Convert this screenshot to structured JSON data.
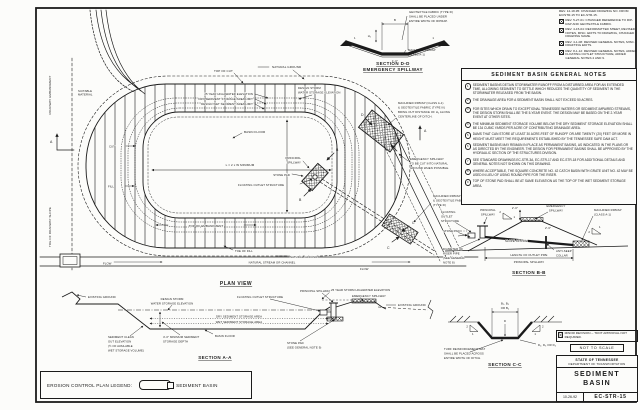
{
  "title_block": {
    "minor_revision_note": "MINOR REVISION -- TDOT APPROVAL NOT REQUIRED.",
    "not_to_scale": "NOT TO SCALE",
    "agency_line1": "STATE OF TENNESSEE",
    "agency_line2": "DEPARTMENT OF TRANSPORTATION",
    "drawing_title_line1": "SEDIMENT",
    "drawing_title_line2": "BASIN",
    "date": "10-26-92",
    "drawing_number": "EC-STR-15"
  },
  "legend": {
    "label": "EROSION CONTROL PLAN LEGEND:",
    "item": "SEDIMENT BASIN"
  },
  "revisions": {
    "items": [
      {
        "text": "REV. 12-18-95: CHANGED DRAWING NO. FROM EC/STR-15 TO EC-STR-15."
      },
      {
        "text": "REV. 5-27-01: CHANGED REFERENCE TO RIP-RAP AND GEOTEXTILE FABRIC."
      },
      {
        "text": "REV. 4-15-04: REFORMATTED SHEET, REVISED NOTES, MISC. EDITS TO DRAWING, CHANGED DRAWING NAME."
      },
      {
        "text": "REV. 4-1-08: REVISED GENERAL NOTES, MISC. DRAFTING EDITS."
      },
      {
        "text": "REV. 8-1-12: REVISED GENERAL NOTES, ADDED FLOATING OUTLET STRUCTURE, ADDED GENERAL NOTES 4 AND 9."
      }
    ]
  },
  "notes": {
    "title": "SEDIMENT BASIN GENERAL NOTES",
    "items": [
      {
        "num": "1",
        "text": "SEDIMENT BASINS DETAIN STORMWATER RUNOFF FROM A DISTURBED AREA FOR AN EXTENDED TIME, ALLOWING SEDIMENT TO SETTLE WHICH REDUCES THE QUANTITY OF SEDIMENT IN THE STORMWATER RELEASED FROM THE BASIN."
      },
      {
        "num": "2",
        "text": "THE DRAINAGE AREA FOR A SEDIMENT BASIN SHALL NOT EXCEED 50 ACRES."
      },
      {
        "num": "3",
        "text": "FOR SITES WHICH DRAIN TO EXCEPTIONAL TENNESSEE WATERS OR SEDIMENT-IMPAIRED STREAMS, THE DESIGN STORM SHALL BE THE 5-YEAR EVENT.  THE DESIGN MAY BE BASED ON THE 2-YEAR EVENT AT OTHER SITES."
      },
      {
        "num": "4",
        "text": "THE MINIMUM SEDIMENT STORAGE VOLUME BELOW THE DRY SEDIMENT STORAGE ELEVATION SHALL BE 134 CUBIC YARDS PER ACRE OF CONTRIBUTING DRAINAGE AREA."
      },
      {
        "num": "5",
        "text": "DAMS THAT CAN STORE AT LEAST 30 ACRE-FEET OF RUNOFF OR ARE TWENTY (20) FEET OR MORE IN HEIGHT MUST MEET THE REQUIREMENTS ESTABLISHED BY THE TENNESSEE SAFE DAM ACT."
      },
      {
        "num": "6",
        "text": "SEDIMENT BASINS MAY REMAIN IN PLACE AS PERMANENT BASINS, AS INDICATED IN THE PLANS OR AS DIRECTED BY THE ENGINEER.  THE DESIGN FOR PERMANENT BASINS SHALL BE APPROVED BY THE HYDRAULIC SECTION OF THE STRUCTURES DIVISION."
      },
      {
        "num": "7",
        "text": "SEE STANDARD DRAWINGS EC-STR-3A, EC-STR-17 AND EC-STR-18 FOR ADDITIONAL DETAILS AND GENERAL NOTES NOT SHOWN ON THIS DRAWING."
      },
      {
        "num": "8",
        "text": "WHERE ACCEPTABLE, THE SQUARE CONCRETE NO. 42 CATCH BASIN WITH GRATE UNIT NO. 42 MAY BE USED IN LIEU OF USING ROUND PIPE FOR THE RISER."
      },
      {
        "num": "9",
        "text": "TOP OF STONE PAD SHALL BE AT SAME ELEVATION AS THE TOP OF THE WET SEDIMENT STORAGE AREA."
      }
    ]
  },
  "plan": {
    "title": "PLAN VIEW",
    "labels": {
      "roadway_embankment": "ROADWAY EMBANKMENT",
      "toe_of_roadway_slope": "TOE OF ROADWAY SLOPE",
      "suitable_material": [
        "SUITABLE",
        "MATERIAL"
      ],
      "top_of_cut": "TOP OF CUT",
      "natural_ground_top": "NATURAL GROUND",
      "hw25": "25 YEAR HIGH WATER ELEVATION",
      "dry_limit": "DRY SEDIMENT STORAGE AREA LIMIT",
      "wet_limit": "DESIGN WET SEDIMENT AREA LIMIT",
      "design_storm": [
        "DESIGN STORM",
        "WATER STORAGE ELEVATION"
      ],
      "basin_floor": "BASIN FLOOR",
      "length_dim": "L = 2 x W MINIMUM",
      "cut": "CUT",
      "fill": "FILL",
      "top_of_embankment": "TOP OF EMBANKMENT",
      "toe_of_fill": "TOE OF FILL",
      "natural_ground_bottom": "NATURAL GROUND",
      "flow": "FLOW",
      "stream": "NATURAL STREAM OR CHANNEL",
      "riprap_ditch_note": [
        "MACHINED RIPRAP (CLASS A-1)",
        "& GEOTEXTILE FABRIC (TYPE III)",
        "BRING OUT DISTANCE OF H₂ ALONG",
        "CENTERLINE OF DITCH."
      ],
      "emergency_note": [
        "EMERGENCY SPILLWAY",
        "TO BE CUT INTO NATURAL",
        "GROUND WHEN POSSIBLE."
      ],
      "riprap_fabric": [
        "MACHINED RIPRAP",
        "& GEOTEXTILE FABRIC",
        "(TYPE III)"
      ],
      "principal_spillway": [
        "PRINCIPAL",
        "SPILLWAY"
      ],
      "stone_pad": "STONE PAD",
      "floating_outlet": "FLOATING OUTLET STRUCTURE",
      "marker_a": "A",
      "marker_b": "B",
      "marker_c": "C",
      "marker_d": "D"
    }
  },
  "section_aa": {
    "title": "SECTION A-A",
    "labels": {
      "existing_ground": "EXISTING GROUND",
      "design_storm": [
        "DESIGN STORM",
        "WATER STORAGE ELEVATION"
      ],
      "floating_outlet": "FLOATING OUTLET STRUCTURE",
      "principal_spillway": "PRINCIPAL SPILLWAY",
      "dry_area": "DRY SEDIMENT STORAGE AREA",
      "wet_area": "WET SEDIMENT STORAGE AREA",
      "cleanout": [
        "SEDIMENT CLEAN",
        "OUT ELEVATION",
        "(½ OF AVAILABLE",
        "WET STORAGE VOLUME)"
      ],
      "min_depth": [
        "4'-0\" MINIMUM SEDIMENT",
        "STORAGE DEPTH"
      ],
      "basin_floor": "BASIN FLOOR",
      "stone_pad": [
        "STONE PAD",
        "(SEE GENERAL NOTE 9)"
      ],
      "hw25": "25 YEAR STORM HIGHWATER ELEVATION",
      "emergency_spillway": "EMERGENCY SPILLWAY",
      "existing_ground_right": "EXISTING GROUND"
    }
  },
  "section_bb": {
    "title": "SECTION B-B",
    "labels": {
      "floating_outlet": [
        "FLOATING",
        "OUTLET",
        "STRUCTURE"
      ],
      "principal": [
        "PRINCIPAL",
        "SPILLWAY"
      ],
      "emergency": [
        "EMERGENCY",
        "SPILLWAY"
      ],
      "riprap": [
        "MACHINED RIPRAP",
        "(CLASS A-1)"
      ],
      "dim1": "2'-0\"",
      "dim2": "2' MIN.",
      "dim3": "2'-6\"",
      "stone_pad": "STONE PAD",
      "slope_of_pipe": "SLOPE OF PIPE",
      "anti_seep": [
        "ANTI-SEEP",
        "COLLAR"
      ],
      "riser_note": [
        "DIAMETER OF",
        "RISER PIPE",
        "(SEE GENERAL",
        "NOTE 8)"
      ],
      "length_dim1": "LENGTH OF OUTLET PIPE",
      "length_dim2": "PRINCIPAL SPILLWAY",
      "slope_run": "2",
      "slope_rise": "1"
    }
  },
  "section_cc": {
    "title": "SECTION C-C",
    "labels": {
      "width_dim": [
        "B₂, B₃",
        "OR B₄"
      ],
      "depth_letter": "D",
      "depth_dim": "D₂, D₃  OR D₄",
      "turf_note": [
        "TURF REINFORCEMENT MAT",
        "SHALL BE PLACED ACROSS",
        "ENTIRE WIDTH OF DITCH."
      ],
      "slope_run": "2",
      "slope_rise": "1"
    }
  },
  "section_dd": {
    "title": [
      "SECTION D-D",
      "EMERGENCY SPILLWAY"
    ],
    "labels": {
      "fabric_note": [
        "GEOTEXTILE FABRIC (TYPE III)",
        "SHALL BE PLACED UNDER",
        "ENTIRE WIDTH OF RIPRAP."
      ],
      "riprap": [
        "MACHINED RIPRAP",
        "(CLASS A-1)"
      ],
      "dim_b": "B",
      "dim_h": "H₂",
      "dim_base": "1'-0\"",
      "slope": "1"
    }
  },
  "colors": {
    "line": "#1b1b1b",
    "paper": "#fcfcfa"
  }
}
